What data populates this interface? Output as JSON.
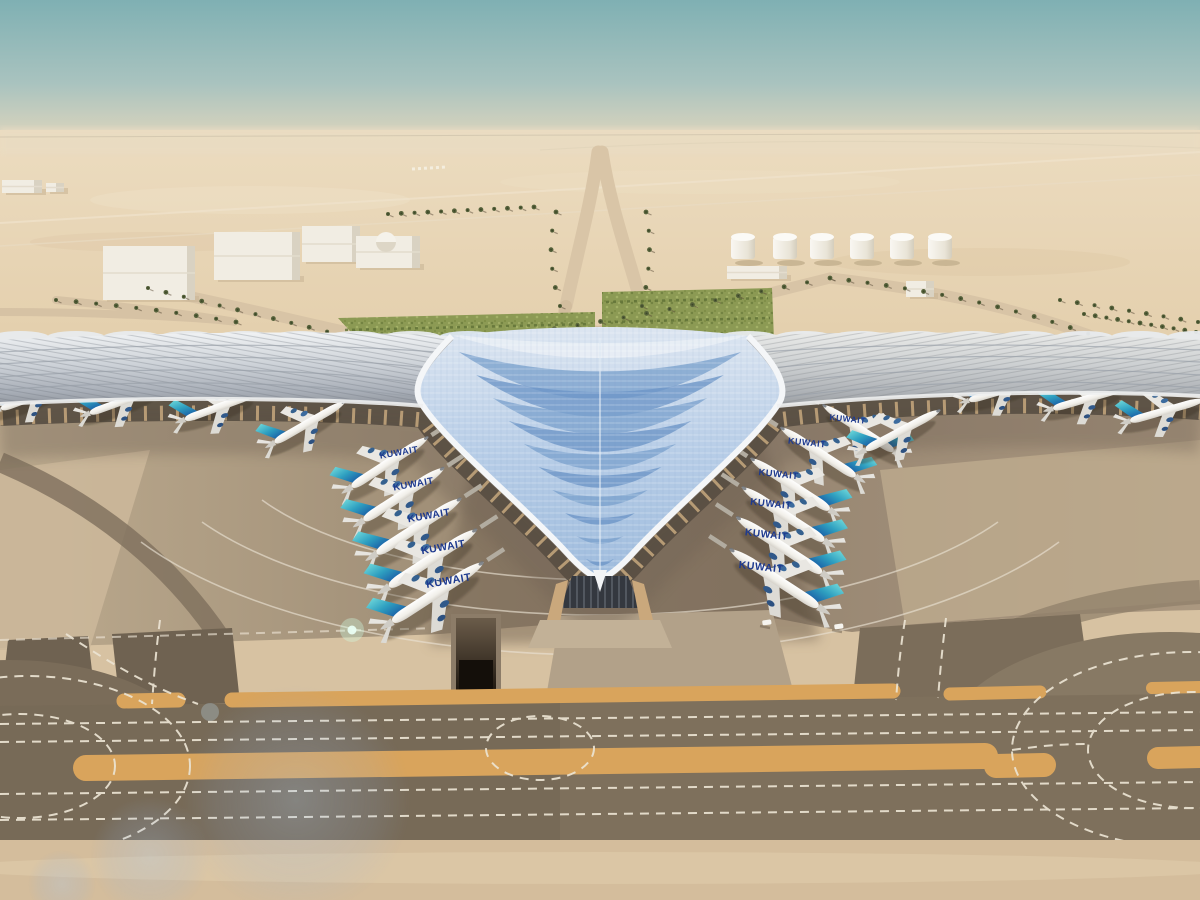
{
  "meta": {
    "subject": "Aerial rendering of a trident-shaped airport terminal in the desert with Kuwait Airways aircraft parked at gates",
    "scene_type": "architectural-aerial-rendering"
  },
  "colors": {
    "sky_top": "#7fb0b3",
    "sky_haze": "#e6dcc4",
    "desert": "#e5d0ae",
    "desert_far": "#ecdcc0",
    "apron_light": "#c4b195",
    "apron_dark": "#70614f",
    "taxiway_asphalt": "#7e705c",
    "sand_strip": "#d7c2a2",
    "marking_white": "#ece4d4",
    "marking_yellow": "#d9a45c",
    "roof_silver": "#ccd1d7",
    "roof_blue": "#b5cbe4",
    "roof_blue_dark": "#6c95c6",
    "roof_rim_white": "#f4f6f8",
    "tail_teal": "#39aebc",
    "tail_blue": "#1b5fa6",
    "fuselage_white": "#f4f3ef",
    "title_blue": "#1e3a8f",
    "palm_green": "#55613a",
    "hedge_green": "#87974f",
    "tank_white": "#f1ede3"
  },
  "aircraft": {
    "label": "KUWAIT",
    "total_count": 19,
    "fleet": [
      {
        "name": "inner-left",
        "mirror": false,
        "angle": -33,
        "label_tilt": -10,
        "labels": true,
        "bridges": true,
        "planes": [
          [
            390,
            462,
            0.95
          ],
          [
            404,
            494,
            1.0
          ],
          [
            419,
            526,
            1.05
          ],
          [
            433,
            558,
            1.09
          ],
          [
            438,
            592,
            1.13
          ]
        ]
      },
      {
        "name": "inner-right",
        "mirror": true,
        "angle": -33,
        "label_tilt": 6,
        "labels": true,
        "bridges": true,
        "planes": [
          [
            858,
            428,
            0.88
          ],
          [
            818,
            452,
            0.93
          ],
          [
            790,
            484,
            0.98
          ],
          [
            783,
            514,
            1.02
          ],
          [
            779,
            545,
            1.06
          ],
          [
            774,
            578,
            1.1
          ]
        ]
      },
      {
        "name": "outer-left",
        "mirror": false,
        "angle": -20,
        "labels": false,
        "bridges": false,
        "planes": [
          [
            36,
            396,
            0.78
          ],
          [
            126,
            400,
            0.8
          ],
          [
            222,
            406,
            0.82
          ],
          [
            310,
            422,
            0.85,
            -30
          ]
        ]
      },
      {
        "name": "outer-right",
        "mirror": false,
        "angle": -16,
        "labels": false,
        "bridges": false,
        "planes": [
          [
            1005,
            390,
            0.78
          ],
          [
            1090,
            398,
            0.8
          ],
          [
            1168,
            410,
            0.82
          ],
          [
            903,
            430,
            0.88,
            -28
          ]
        ]
      }
    ]
  },
  "landside": {
    "buildings": [
      {
        "x": 103,
        "y": 246,
        "w": 92,
        "h": 54
      },
      {
        "x": 214,
        "y": 232,
        "w": 86,
        "h": 48
      },
      {
        "x": 302,
        "y": 226,
        "w": 58,
        "h": 36
      },
      {
        "x": 356,
        "y": 236,
        "w": 64,
        "h": 32
      },
      {
        "x": 727,
        "y": 266,
        "w": 60,
        "h": 13
      },
      {
        "x": 906,
        "y": 281,
        "w": 28,
        "h": 16
      },
      {
        "x": 2,
        "y": 180,
        "w": 40,
        "h": 13
      },
      {
        "x": 46,
        "y": 183,
        "w": 18,
        "h": 9
      }
    ],
    "dome": {
      "cx": 386,
      "cy": 242,
      "r": 10
    },
    "fuel_tanks_x": [
      743,
      785,
      822,
      862,
      902,
      940
    ],
    "fuel_tanks_y": 237,
    "palm_rows": [
      {
        "guide": "pg1",
        "count": 12
      },
      {
        "guide": "pg2",
        "count": 22
      },
      {
        "guide": "pg3",
        "count": 16
      },
      {
        "guide": "pg4",
        "count": 6
      },
      {
        "guide": "pg5",
        "count": 6
      },
      {
        "guide": "pg6",
        "count": 12
      },
      {
        "guide": "pg7",
        "count": 11
      },
      {
        "guide": "pg8",
        "count": 9
      },
      {
        "guide": "pg9",
        "count": 10
      }
    ]
  },
  "terminal": {
    "roof_chevrons": {
      "rows": 10,
      "y_start": 352,
      "y_step": 23,
      "tip_y": 580,
      "max_halfwidth": 150,
      "colors": [
        "#7ba1cd",
        "#6c95c6"
      ],
      "top_white": "#e9eef5"
    },
    "scallops": {
      "step": 56,
      "ry": 7
    }
  },
  "airfield": {
    "dash_pattern": "9 7",
    "vehicles": [
      [
        766,
        620
      ],
      [
        838,
        624
      ]
    ]
  }
}
